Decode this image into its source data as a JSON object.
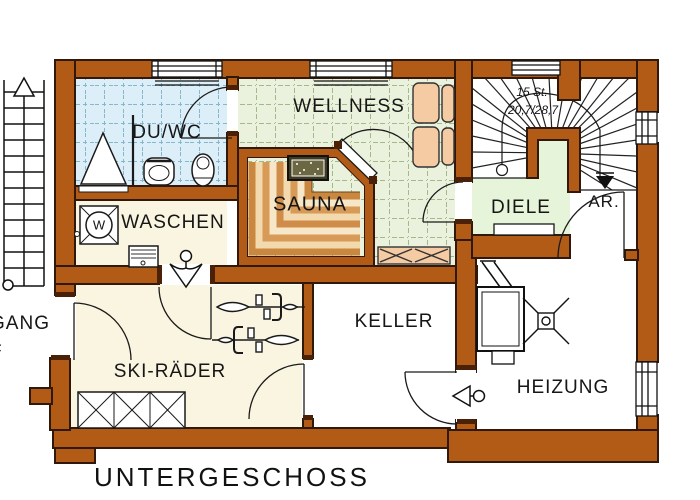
{
  "title": {
    "text": "UNTERGESCHOSS"
  },
  "rooms": {
    "duwc": "DU/WC",
    "wellness": "WELLNESS",
    "sauna": "SAUNA",
    "waschen": "WASCHEN",
    "diele": "DIELE",
    "ar": "AR.",
    "keller": "KELLER",
    "ski": "SKI-RÄDER",
    "heizung": "HEIZUNG",
    "gang": "GANG",
    "gang_partial": "F"
  },
  "stairs": {
    "count": "15 St.",
    "dimensions": "20,7/28,7"
  },
  "appliances": {
    "washing_machine_letter": "W"
  },
  "colors": {
    "wall": "#b25b17",
    "wall_outline": "#30190a",
    "tile_blue": "#dceef7",
    "tile_green": "#eaf2dd",
    "floor_cream": "#f9f5e1",
    "floor_diele": "#e6f4da",
    "furniture_peach": "#f5cba3",
    "bench_tan": "#d89a57",
    "heater_dark": "#3c3a20"
  }
}
